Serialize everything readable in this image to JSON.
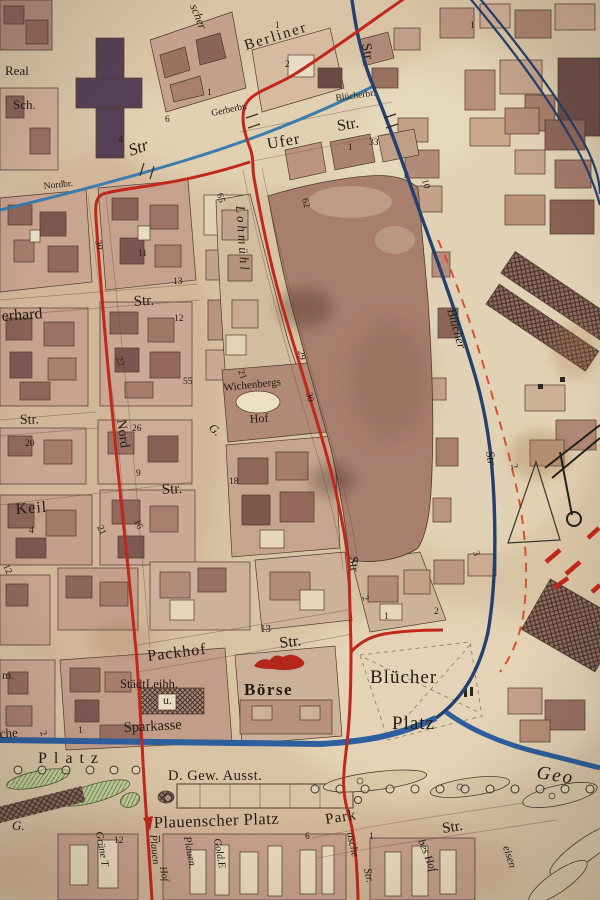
{
  "map": {
    "colors": {
      "paper": "#d8c3a4",
      "ink": "#241c12",
      "tram": "#c1281b",
      "boundary": "#d8502f",
      "stream": "#3d7cab",
      "river": "#24406e",
      "canal": "#2d5f9e",
      "red_ink": "#b5261c",
      "maroon": "#7c1f12",
      "park": "#b9c893"
    },
    "labels": [
      {
        "t": "Berliner",
        "x": 246,
        "y": 50,
        "s": 15,
        "r": -17,
        "ls": 2,
        "n": "street-label-berliner"
      },
      {
        "t": "scher",
        "x": 190,
        "y": 6,
        "s": 12,
        "r": 68,
        "i": 1,
        "n": "street-label-fragment"
      },
      {
        "t": "Str",
        "x": 362,
        "y": 44,
        "s": 14,
        "r": 80,
        "n": "street-label-str-top"
      },
      {
        "t": "Gerberbr.",
        "x": 212,
        "y": 116,
        "s": 9.5,
        "r": -12,
        "n": "bridge-label-gerberbr"
      },
      {
        "t": "Blücherbr.",
        "x": 336,
        "y": 101,
        "s": 9.5,
        "r": -8,
        "n": "bridge-label-bluecherbr"
      },
      {
        "t": "Ufer",
        "x": 268,
        "y": 149,
        "s": 16,
        "r": -10,
        "ls": 1,
        "n": "street-label-ufer"
      },
      {
        "t": "Str.",
        "x": 338,
        "y": 131,
        "s": 16,
        "r": -10,
        "n": "street-label-ufer-str"
      },
      {
        "t": "Real",
        "x": 5,
        "y": 75,
        "s": 13,
        "n": "label-realschule-1"
      },
      {
        "t": "Sch.",
        "x": 13,
        "y": 109,
        "s": 13,
        "n": "label-realschule-2"
      },
      {
        "t": "Nordbr.",
        "x": 44,
        "y": 189,
        "s": 9.5,
        "r": -6,
        "n": "bridge-label-nordbr"
      },
      {
        "t": "Str",
        "x": 131,
        "y": 156,
        "s": 17,
        "r": -20,
        "i": 1
      },
      {
        "t": "erhard",
        "x": 2,
        "y": 321,
        "s": 16,
        "r": -4,
        "n": "street-label-gerhard"
      },
      {
        "t": "Str.",
        "x": 134,
        "y": 306,
        "s": 15,
        "r": -4
      },
      {
        "t": "Str.",
        "x": 20,
        "y": 424,
        "s": 14,
        "r": -2
      },
      {
        "t": "Keil",
        "x": 16,
        "y": 514,
        "s": 16,
        "r": -4,
        "ls": 1,
        "n": "street-label-keil"
      },
      {
        "t": "Str.",
        "x": 162,
        "y": 494,
        "s": 15,
        "r": -3
      },
      {
        "t": "Nord",
        "x": 117,
        "y": 420,
        "s": 14,
        "r": 82,
        "n": "street-label-nord"
      },
      {
        "t": "Str",
        "x": 349,
        "y": 557,
        "s": 13,
        "r": 84
      },
      {
        "t": "Lohmühl",
        "x": 236,
        "y": 206,
        "s": 13,
        "r": 86,
        "i": 1,
        "ls": 3,
        "n": "street-label-lohmuehl"
      },
      {
        "t": "G.",
        "x": 208,
        "y": 429,
        "s": 12,
        "r": 40,
        "i": 1
      },
      {
        "t": "Wichenbergs",
        "x": 224,
        "y": 391,
        "s": 11,
        "r": -6,
        "n": "label-wichenbergs-hof"
      },
      {
        "t": "Hof",
        "x": 250,
        "y": 423,
        "s": 12,
        "r": -4
      },
      {
        "t": "Packhof",
        "x": 148,
        "y": 661,
        "s": 16,
        "r": -7,
        "ls": 1,
        "n": "street-label-packhof"
      },
      {
        "t": "Str.",
        "x": 280,
        "y": 648,
        "s": 16,
        "r": -7
      },
      {
        "t": "StädtLeihh.",
        "x": 120,
        "y": 688,
        "s": 12.5,
        "n": "label-staedt-leihhaus"
      },
      {
        "t": "u.",
        "x": 163,
        "y": 704,
        "s": 12
      },
      {
        "t": "Sparkasse",
        "x": 124,
        "y": 732,
        "s": 14.5,
        "r": -3,
        "n": "label-sparkasse"
      },
      {
        "t": "Börse",
        "x": 244,
        "y": 695,
        "s": 17,
        "ls": 1.5,
        "w": 600,
        "n": "label-boerse"
      },
      {
        "t": "Blücher",
        "x": 370,
        "y": 683,
        "s": 19,
        "ls": 1,
        "n": "label-bluecher-platz-1"
      },
      {
        "t": "Platz",
        "x": 392,
        "y": 729,
        "s": 19,
        "ls": 1,
        "n": "label-bluecher-platz-2"
      },
      {
        "t": "Blücher",
        "x": 447,
        "y": 310,
        "s": 13,
        "r": 74,
        "i": 1,
        "c": "#1c2f4e",
        "n": "street-label-bluecher-str"
      },
      {
        "t": "Str",
        "x": 486,
        "y": 452,
        "s": 12,
        "r": 80,
        "i": 1,
        "c": "#1c2f4e"
      },
      {
        "t": "D. Gew. Ausst.",
        "x": 168,
        "y": 780,
        "s": 14.5,
        "ls": 0.5,
        "n": "label-gewerbe-ausstellung"
      },
      {
        "t": "Plauenscher Platz",
        "x": 154,
        "y": 828,
        "s": 16.5,
        "r": -2,
        "ls": 0.5,
        "c": "#7c1f12",
        "n": "label-plauenscher-platz"
      },
      {
        "t": "Park",
        "x": 326,
        "y": 824,
        "s": 15,
        "r": -9,
        "ls": 1,
        "n": "street-label-park"
      },
      {
        "t": "Str.",
        "x": 443,
        "y": 833,
        "s": 15,
        "r": -9
      },
      {
        "t": "Geo",
        "x": 536,
        "y": 778,
        "s": 19,
        "r": 9,
        "i": 1,
        "ls": 2,
        "n": "label-geo"
      },
      {
        "t": "Platz",
        "x": 38,
        "y": 763,
        "s": 16,
        "ls": 7,
        "n": "label-platz-west"
      },
      {
        "t": "che",
        "x": 0,
        "y": 738,
        "s": 13,
        "r": -4
      },
      {
        "t": "m.",
        "x": 2,
        "y": 679,
        "s": 12
      },
      {
        "t": "G.",
        "x": 12,
        "y": 830,
        "s": 13,
        "i": 1
      },
      {
        "t": "Grüne T",
        "x": 96,
        "y": 832,
        "s": 10.5,
        "r": 80,
        "i": 1,
        "n": "street-label-gruene"
      },
      {
        "t": "Plauen",
        "x": 150,
        "y": 835,
        "s": 10.5,
        "r": 84,
        "i": 1,
        "c": "#b5261c",
        "n": "street-label-plauen-red"
      },
      {
        "t": "Hof",
        "x": 160,
        "y": 867,
        "s": 10,
        "r": 80,
        "i": 1
      },
      {
        "t": "Plauen.",
        "x": 184,
        "y": 837,
        "s": 10.5,
        "r": 80,
        "i": 1
      },
      {
        "t": "Gold.E",
        "x": 214,
        "y": 839,
        "s": 10.5,
        "r": 80,
        "i": 1
      },
      {
        "t": "asche",
        "x": 347,
        "y": 833,
        "s": 11,
        "r": 78,
        "i": 1
      },
      {
        "t": "Str.",
        "x": 364,
        "y": 869,
        "s": 11,
        "r": 78,
        "i": 1
      },
      {
        "t": "bes Hof",
        "x": 418,
        "y": 841,
        "s": 11,
        "r": 68,
        "i": 1
      },
      {
        "t": "eisen",
        "x": 503,
        "y": 847,
        "s": 11,
        "r": 72,
        "i": 1
      }
    ],
    "numbers": [
      {
        "t": "30",
        "x": 95,
        "y": 241,
        "r": 75
      },
      {
        "t": "13",
        "x": 173,
        "y": 284
      },
      {
        "t": "12",
        "x": 174,
        "y": 321
      },
      {
        "t": "22",
        "x": 116,
        "y": 358,
        "r": 70
      },
      {
        "t": "55",
        "x": 183,
        "y": 384
      },
      {
        "t": "65",
        "x": 217,
        "y": 194,
        "r": 75
      },
      {
        "t": "11",
        "x": 138,
        "y": 256
      },
      {
        "t": "21",
        "x": 238,
        "y": 371,
        "r": 70
      },
      {
        "t": "26",
        "x": 132,
        "y": 431
      },
      {
        "t": "20",
        "x": 25,
        "y": 446
      },
      {
        "t": "9",
        "x": 136,
        "y": 476
      },
      {
        "t": "16",
        "x": 134,
        "y": 521,
        "r": 65
      },
      {
        "t": "21",
        "x": 97,
        "y": 527,
        "r": 65
      },
      {
        "t": "4",
        "x": 29,
        "y": 533
      },
      {
        "t": "12",
        "x": 3,
        "y": 566,
        "r": 65
      },
      {
        "t": "18",
        "x": 229,
        "y": 484
      },
      {
        "t": "10",
        "x": 422,
        "y": 180,
        "r": 75
      },
      {
        "t": "4",
        "x": 118,
        "y": 142
      },
      {
        "t": "6",
        "x": 165,
        "y": 122
      },
      {
        "t": "1",
        "x": 207,
        "y": 95
      },
      {
        "t": "1",
        "x": 275,
        "y": 28
      },
      {
        "t": "2",
        "x": 285,
        "y": 67
      },
      {
        "t": "1",
        "x": 470,
        "y": 28
      },
      {
        "t": "1",
        "x": 348,
        "y": 150
      },
      {
        "t": "33",
        "x": 369,
        "y": 145
      },
      {
        "t": "62",
        "x": 302,
        "y": 199,
        "r": 75
      },
      {
        "t": "29",
        "x": 298,
        "y": 351,
        "r": 78
      },
      {
        "t": "30",
        "x": 306,
        "y": 393,
        "r": 78
      },
      {
        "t": "2",
        "x": 362,
        "y": 597,
        "r": 70
      },
      {
        "t": "1",
        "x": 384,
        "y": 619
      },
      {
        "t": "2",
        "x": 434,
        "y": 614
      },
      {
        "t": "3",
        "x": 473,
        "y": 552,
        "r": 70
      },
      {
        "t": "2",
        "x": 511,
        "y": 465,
        "r": 70
      },
      {
        "t": "13",
        "x": 260,
        "y": 632,
        "s": 11
      },
      {
        "t": "1",
        "x": 78,
        "y": 733
      },
      {
        "t": "2",
        "x": 40,
        "y": 732,
        "r": 70
      },
      {
        "t": "12",
        "x": 114,
        "y": 843
      },
      {
        "t": "1",
        "x": 157,
        "y": 842
      },
      {
        "t": "6",
        "x": 305,
        "y": 839
      },
      {
        "t": "1",
        "x": 369,
        "y": 839
      }
    ]
  }
}
